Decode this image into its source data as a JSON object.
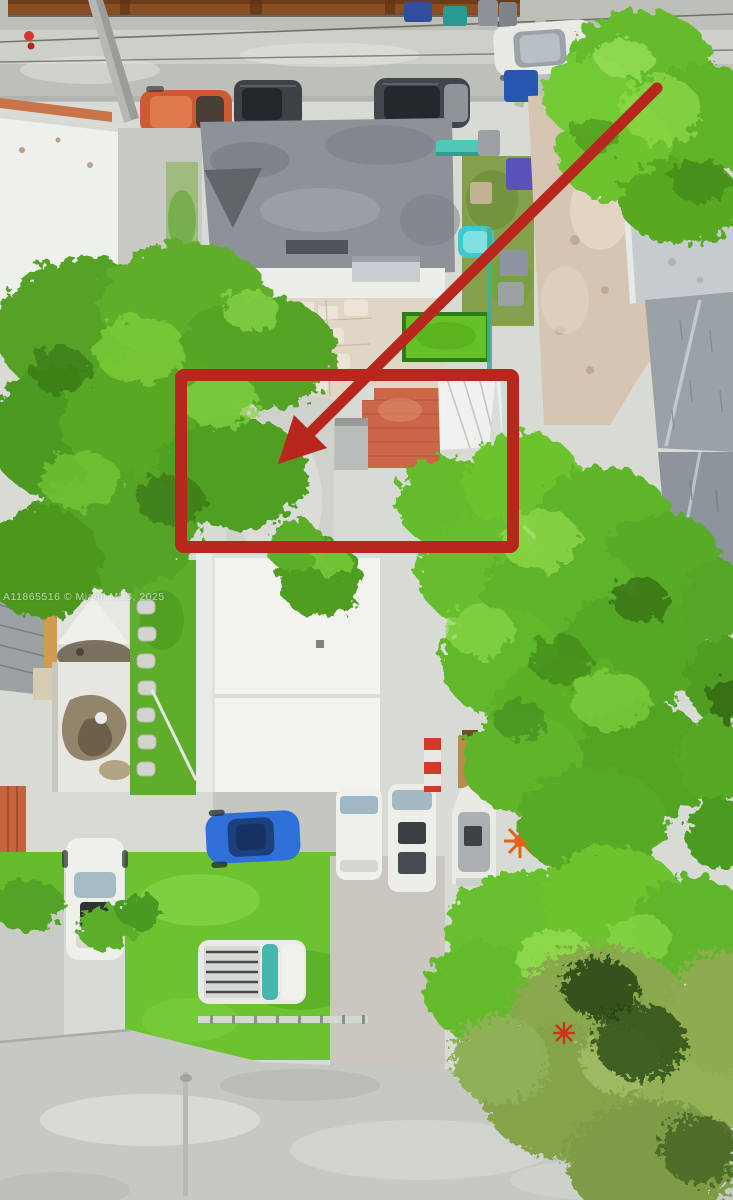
{
  "meta": {
    "type": "aerial-drone-photo",
    "description": "Overhead aerial photo of a residential lot in Miami with a red highlight rectangle and a red arrow pointing to the subject property"
  },
  "watermark": {
    "text": "A11865516  © Miami MLS, 2025"
  },
  "annotations": {
    "highlight_box": {
      "x": 181,
      "y": 375,
      "width": 332,
      "height": 172,
      "stroke_width": 12,
      "corner_radius": 3,
      "color": "#b8271d"
    },
    "arrow": {
      "x1": 657,
      "y1": 88,
      "x2": 311,
      "y2": 432,
      "stroke_width": 11,
      "head_points": "278,464 294,415 327,448",
      "color": "#b8271d"
    }
  },
  "palette": {
    "annotation_red": "#b8271d",
    "street_gray": "#bcc0b8",
    "pavement_light": "#d8dad4",
    "grass_bright": "#6cc32f",
    "tree_green": "#5fae2b",
    "tree_highlight": "#8ed847",
    "tree_shadow": "#3f8619",
    "roof_white": "#f3f4f0",
    "roof_gray": "#8d9298",
    "shingle_gray": "#9aa1a7",
    "sand_tan": "#d5c5b2",
    "terracotta": "#cb6747",
    "rust_brown": "#8a4e22",
    "pool_teal": "#3fc9cd",
    "car_blue": "#2f6fd8",
    "car_orange": "#cc5b33",
    "flower_orange": "#e8611c"
  }
}
